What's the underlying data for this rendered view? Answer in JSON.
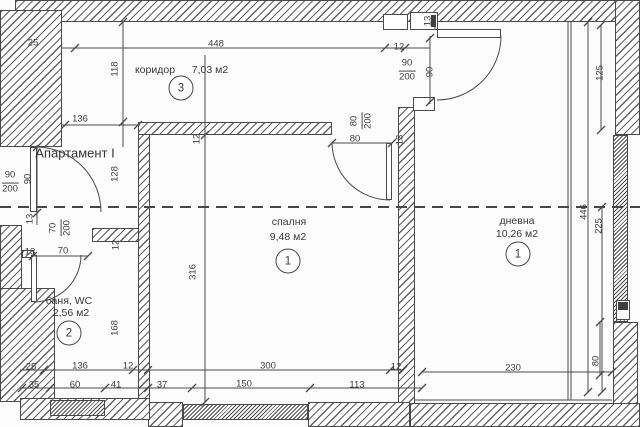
{
  "title": "Апартамент I",
  "colors": {
    "paper": "#fcfcfc",
    "ink": "#3d3d3d",
    "wall_line": "#4a4a4a"
  },
  "rooms": [
    {
      "name": "коридор",
      "area": "7,03 м2",
      "number": "3",
      "name_pos": [
        155,
        70
      ],
      "area_pos": [
        210,
        70
      ],
      "circle_pos": [
        181,
        88
      ]
    },
    {
      "name": "спалня",
      "area": "9,48 м2",
      "number": "1",
      "name_pos": [
        289,
        222
      ],
      "area_pos": [
        288,
        237
      ],
      "circle_pos": [
        288,
        261
      ]
    },
    {
      "name": "дневна",
      "area": "10,26 м2",
      "number": "1",
      "name_pos": [
        517,
        221
      ],
      "area_pos": [
        517,
        234
      ],
      "circle_pos": [
        518,
        254
      ]
    },
    {
      "name": "баня, WC",
      "area": "2,56 м2",
      "number": "2",
      "name_pos": [
        69,
        301
      ],
      "area_pos": [
        71,
        313
      ],
      "circle_pos": [
        69,
        333
      ]
    }
  ],
  "dimension_labels": [
    {
      "t": "25",
      "x": 33,
      "y": 43,
      "r": 0
    },
    {
      "t": "448",
      "x": 216,
      "y": 44,
      "r": 0
    },
    {
      "t": "12",
      "x": 399,
      "y": 47,
      "r": 0
    },
    {
      "t": "118",
      "x": 115,
      "y": 69,
      "r": 1
    },
    {
      "t": "136",
      "x": 80,
      "y": 119,
      "r": 0
    },
    {
      "t": "13",
      "x": 428,
      "y": 21,
      "r": 1
    },
    {
      "t": "90",
      "x": 430,
      "y": 72,
      "r": 1
    },
    {
      "t": "125",
      "x": 600,
      "y": 73,
      "r": 1
    },
    {
      "t": "12",
      "x": 197,
      "y": 139,
      "r": 1
    },
    {
      "t": "80",
      "x": 355,
      "y": 139,
      "r": 0
    },
    {
      "t": "13",
      "x": 400,
      "y": 140,
      "r": 1
    },
    {
      "t": "90",
      "x": 28,
      "y": 179,
      "r": 1
    },
    {
      "t": "128",
      "x": 115,
      "y": 174,
      "r": 1
    },
    {
      "t": "13",
      "x": 30,
      "y": 219,
      "r": 1
    },
    {
      "t": "13",
      "x": 30,
      "y": 252,
      "r": 0
    },
    {
      "t": "70",
      "x": 63,
      "y": 251,
      "r": 0
    },
    {
      "t": "12",
      "x": 116,
      "y": 245,
      "r": 1
    },
    {
      "t": "316",
      "x": 193,
      "y": 272,
      "r": 1
    },
    {
      "t": "168",
      "x": 115,
      "y": 328,
      "r": 1
    },
    {
      "t": "446",
      "x": 584,
      "y": 212,
      "r": 1
    },
    {
      "t": "225",
      "x": 599,
      "y": 226,
      "r": 1
    },
    {
      "t": "25",
      "x": 31,
      "y": 367,
      "r": 0
    },
    {
      "t": "136",
      "x": 80,
      "y": 366,
      "r": 0
    },
    {
      "t": "12",
      "x": 128,
      "y": 366,
      "r": 0
    },
    {
      "t": "35",
      "x": 34,
      "y": 385,
      "r": 0
    },
    {
      "t": "60",
      "x": 75,
      "y": 385,
      "r": 0
    },
    {
      "t": "41",
      "x": 116,
      "y": 385,
      "r": 0
    },
    {
      "t": "300",
      "x": 268,
      "y": 366,
      "r": 0
    },
    {
      "t": "12",
      "x": 396,
      "y": 367,
      "r": 0
    },
    {
      "t": "37",
      "x": 162,
      "y": 385,
      "r": 0
    },
    {
      "t": "150",
      "x": 244,
      "y": 384,
      "r": 0
    },
    {
      "t": "113",
      "x": 357,
      "y": 385,
      "r": 0
    },
    {
      "t": "230",
      "x": 513,
      "y": 368,
      "r": 0
    },
    {
      "t": "80",
      "x": 596,
      "y": 361,
      "r": 1
    }
  ],
  "door_size_labels": [
    {
      "num": "90",
      "den": "200",
      "x": 407,
      "y": 71,
      "r": 0
    },
    {
      "num": "90",
      "den": "200",
      "x": 10,
      "y": 183,
      "r": 0
    },
    {
      "num": "70",
      "den": "200",
      "x": 61,
      "y": 228,
      "r": 1
    },
    {
      "num": "80",
      "den": "200",
      "x": 362,
      "y": 121,
      "r": 1
    }
  ]
}
